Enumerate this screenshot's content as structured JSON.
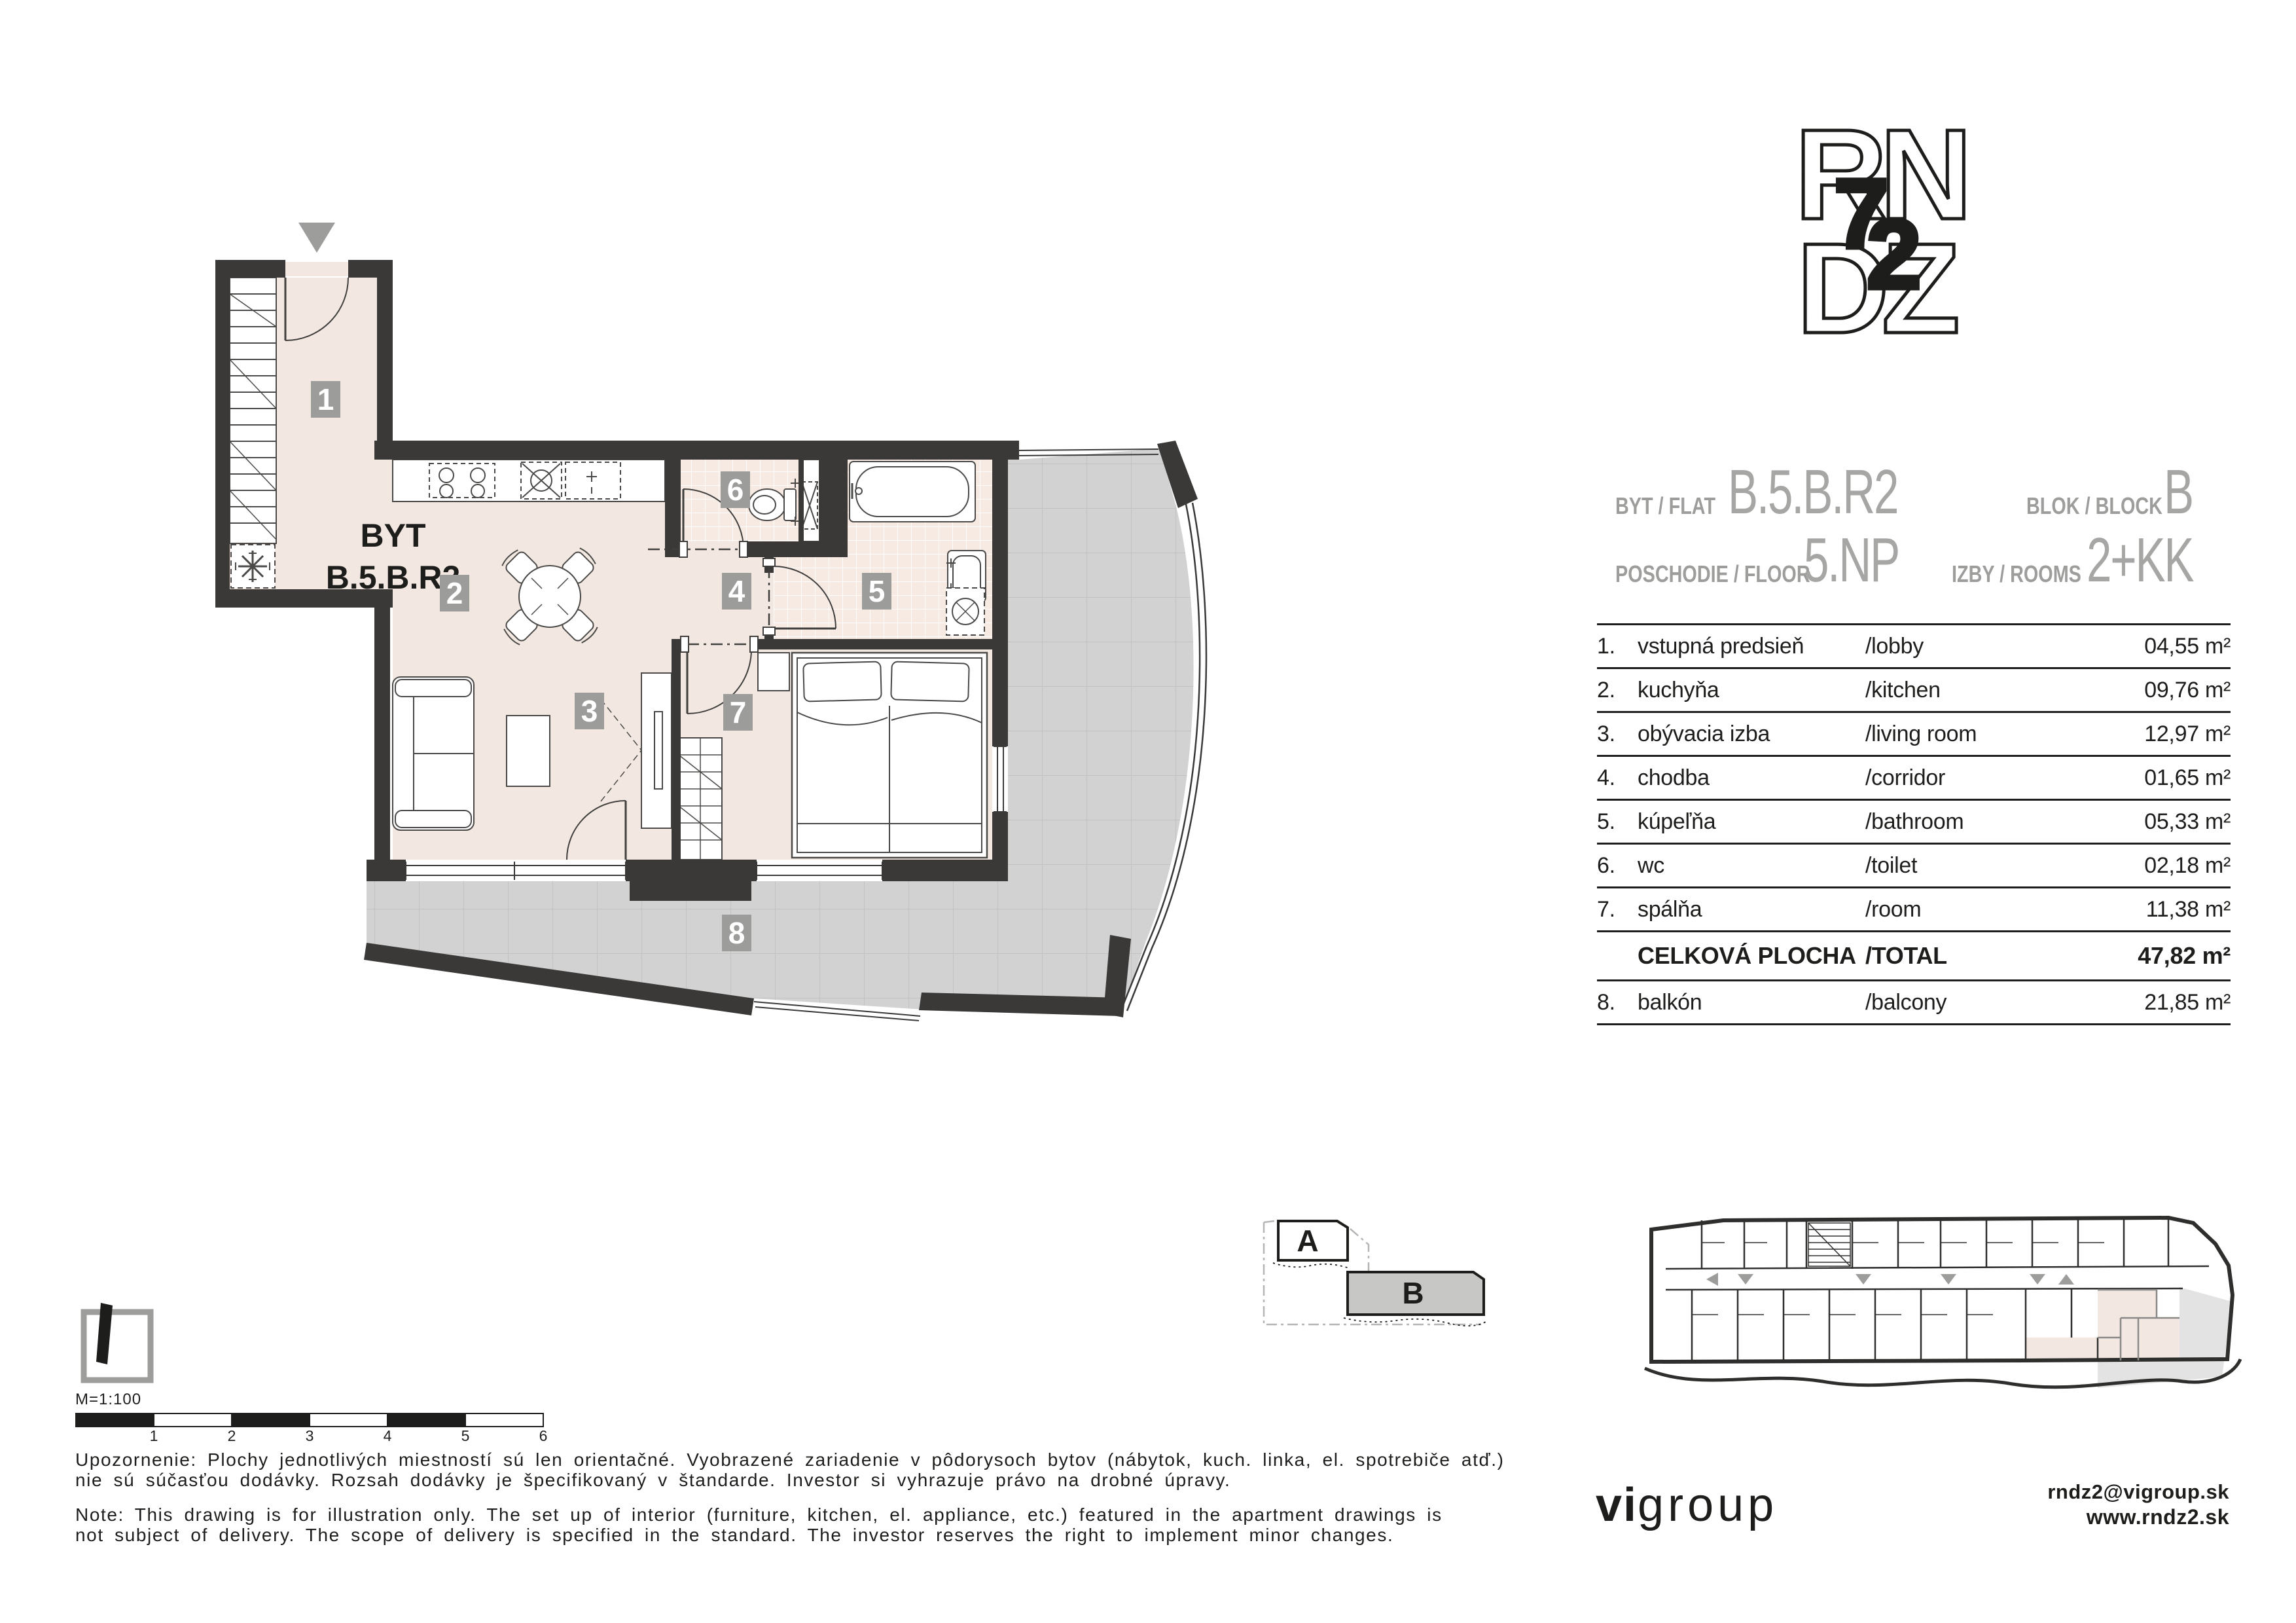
{
  "logo": {
    "r": "R",
    "n": "N",
    "d": "D",
    "z": "Z",
    "digit7": "7",
    "digit2": "2"
  },
  "header": {
    "flat_label": "BYT / FLAT",
    "flat_value": "B.5.B.R2",
    "block_label": "BLOK / BLOCK",
    "block_value": "B",
    "floor_label": "POSCHODIE / FLOOR",
    "floor_value": "5.NP",
    "rooms_label": "IZBY / ROOMS",
    "rooms_value": "2+KK"
  },
  "plan": {
    "unit_label_line1": "BYT",
    "unit_label_line2": "B.5.B.R2",
    "badges": [
      "1",
      "2",
      "3",
      "4",
      "5",
      "6",
      "7",
      "8"
    ]
  },
  "table": {
    "rows": [
      {
        "num": "1.",
        "sk": "vstupná predsieň",
        "en": "/lobby",
        "area": "04,55 m²"
      },
      {
        "num": "2.",
        "sk": "kuchyňa",
        "en": "/kitchen",
        "area": "09,76 m²"
      },
      {
        "num": "3.",
        "sk": "obývacia izba",
        "en": "/living room",
        "area": "12,97 m²"
      },
      {
        "num": "4.",
        "sk": "chodba",
        "en": "/corridor",
        "area": "01,65 m²"
      },
      {
        "num": "5.",
        "sk": "kúpeľňa",
        "en": "/bathroom",
        "area": "05,33 m²"
      },
      {
        "num": "6.",
        "sk": "wc",
        "en": "/toilet",
        "area": "02,18 m²"
      },
      {
        "num": "7.",
        "sk": "spálňa",
        "en": "/room",
        "area": "11,38 m²"
      }
    ],
    "total": {
      "sk": "CELKOVÁ PLOCHA",
      "en": "/TOTAL",
      "area": "47,82 m²"
    },
    "balcony_row": {
      "num": "8.",
      "sk": "balkón",
      "en": "/balcony",
      "area": "21,85 m²"
    }
  },
  "key_plan": {
    "block_a": "A",
    "block_b": "B"
  },
  "scale": {
    "label": "M=1:100",
    "ticks": [
      "1",
      "2",
      "3",
      "4",
      "5",
      "6"
    ]
  },
  "notes": {
    "sk": [
      "Upozornenie: Plochy jednotlivých miestností sú len orientačné. Vyobrazené zariadenie v pôdorysoch bytov (nábytok, kuch. linka, el. spotrebiče atď.)",
      "nie sú súčasťou dodávky. Rozsah dodávky je špecifikovaný v štandarde. Investor si vyhrazuje právo na drobné úpravy."
    ],
    "en": [
      "Note: This drawing is for illustration only. The set up of interior (furniture, kitchen, el. appliance, etc.) featured in the apartment drawings is",
      "not subject of delivery. The scope of delivery is specified in the standard. The investor reserves the right to implement minor changes."
    ]
  },
  "footer": {
    "brand_bold": "vi",
    "brand_light": "group",
    "email": "rndz2@vigroup.sk",
    "web": "www.rndz2.sk"
  }
}
